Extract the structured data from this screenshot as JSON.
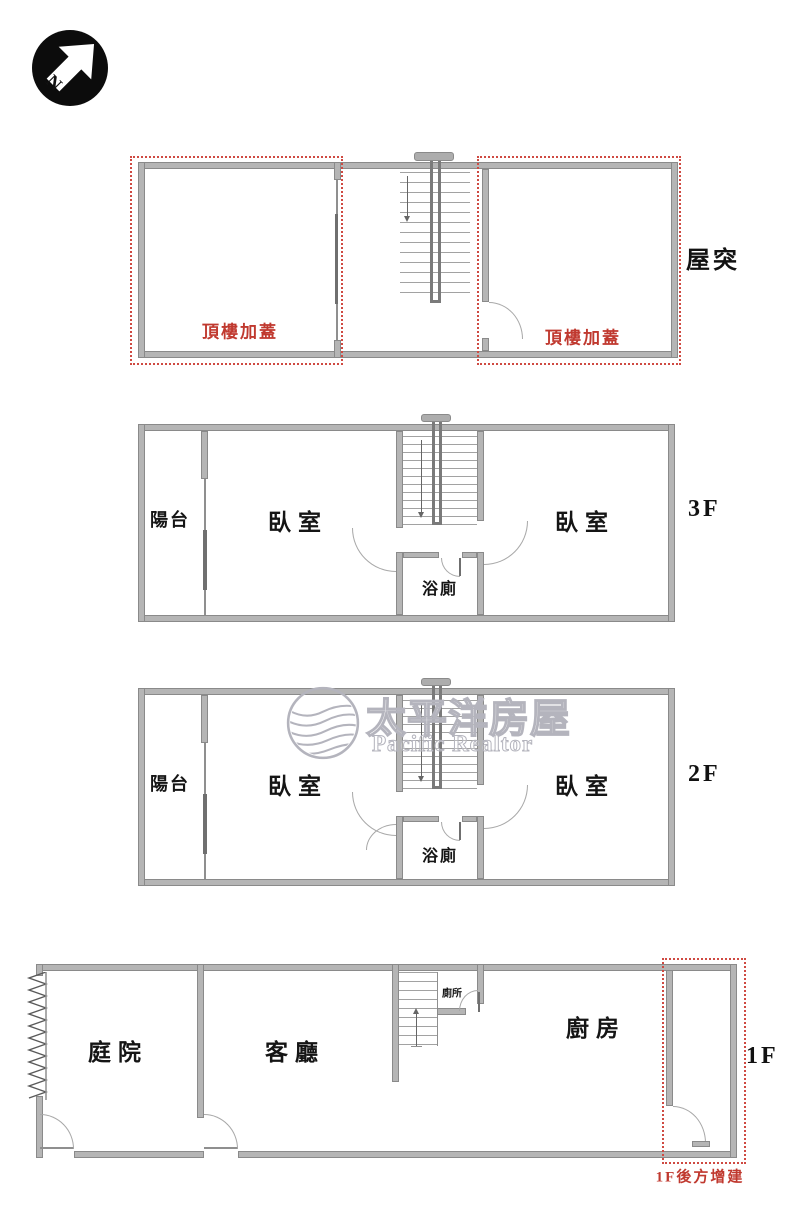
{
  "compass": {
    "letter": "N"
  },
  "watermark": {
    "brand_zh": "太平洋房屋",
    "brand_en": "Pacific Realtor"
  },
  "floors": {
    "roof": {
      "label": "屋突",
      "addition_left": "頂樓加蓋",
      "addition_right": "頂樓加蓋"
    },
    "f3": {
      "label": "3F",
      "balcony": "陽台",
      "bedroom_left": "臥室",
      "bedroom_right": "臥室",
      "bath": "浴廁"
    },
    "f2": {
      "label": "2F",
      "balcony": "陽台",
      "bedroom_left": "臥室",
      "bedroom_right": "臥室",
      "bath": "浴廁"
    },
    "f1": {
      "label": "1F",
      "courtyard": "庭院",
      "living": "客廳",
      "toilet": "廁所",
      "kitchen": "廚房",
      "addition": "1F後方增建"
    }
  },
  "colors": {
    "wall": "#b5b5b5",
    "annotation_red": "#c0392f",
    "watermark_gray": "#b4b4bd"
  }
}
